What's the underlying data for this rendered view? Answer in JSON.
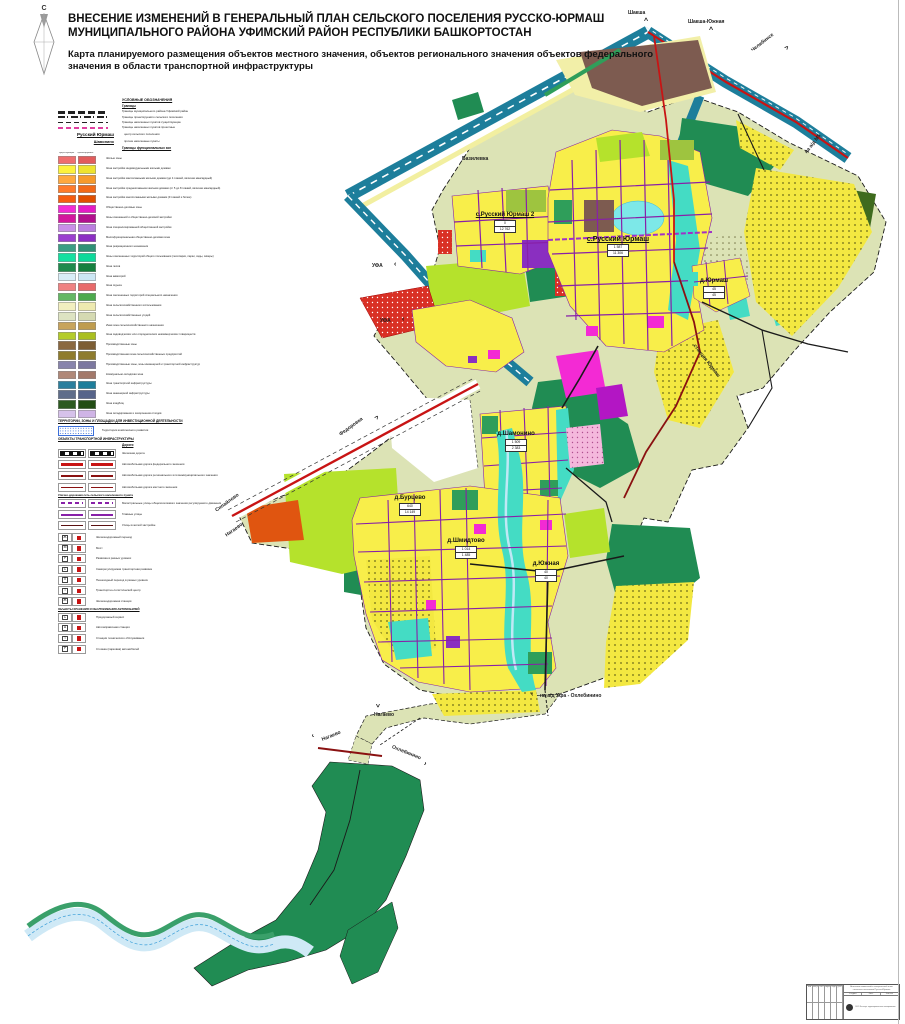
{
  "header": {
    "title": "ВНЕСЕНИЕ ИЗМЕНЕНИЙ В ГЕНЕРАЛЬНЫЙ ПЛАН СЕЛЬСКОГО ПОСЕЛЕНИЯ РУССКО-ЮРМАШ МУНИЦИПАЛЬНОГО РАЙОНА УФИМСКИЙ РАЙОН РЕСПУБЛИКИ БАШКОРТОСТАН",
    "subtitle": "Карта планируемого размещения объектов местного значения, объектов регионального значения объектов федерального значения в области транспортной инфраструктуры",
    "north_label": "С"
  },
  "legend": {
    "title": "УСЛОВНЫЕ ОБОЗНАЧЕНИЯ",
    "boundaries_title": "Границы",
    "boundaries": [
      {
        "style": "b-mun",
        "label": "Границы муниципального района Уфимский район"
      },
      {
        "style": "b-sp",
        "label": "Границы проектируемого сельского поселения"
      },
      {
        "style": "b-npe",
        "label": "Границы населенных пунктов существующие"
      },
      {
        "style": "b-npp",
        "label": "Границы населенных пунктов проектные"
      }
    ],
    "centers": [
      {
        "name": "Русский Юрмаш",
        "desc": "центр сельского поселения",
        "cls": "b"
      },
      {
        "name": "Шамонино",
        "desc": "прочие населенные пункты",
        "cls": "s"
      }
    ],
    "zones_title": "Границы функциональных зон",
    "col_existing": "существующие",
    "col_planned": "проектируемые",
    "zones": [
      {
        "label": "Жилые зоны",
        "c1": "#ef6e6e",
        "c2": "#e25c5c"
      },
      {
        "label": "Зона застройки индивидуальными жилыми домами",
        "c1": "#fdf23c",
        "c2": "#eee32e"
      },
      {
        "label": "Зона застройки малоэтажными жилыми домами (до 4 этажей, включая мансардный)",
        "c1": "#ffa83e",
        "c2": "#f79a2b"
      },
      {
        "label": "Зона застройки среднеэтажными жилыми домами (от 5 до 8 этажей, включая мансардный)",
        "c1": "#ff7a2a",
        "c2": "#f36a18"
      },
      {
        "label": "Зона застройки многоэтажными жилыми домами (9 этажей и более)",
        "c1": "#f65c10",
        "c2": "#e14f00"
      },
      {
        "label": "Общественно-деловые зоны",
        "c1": "#f32ad4",
        "c2": "#e51bc5"
      },
      {
        "label": "Зоны смешанной и общественно-деловой застройки",
        "c1": "#d4179e",
        "c2": "#b30f8e"
      },
      {
        "label": "Зона специализированной общественной застройки",
        "c1": "#c98fe8",
        "c2": "#bb7ee0"
      },
      {
        "label": "Многофункциональная общественно-деловая зона",
        "c1": "#9b3fd0",
        "c2": "#8c2fc4"
      },
      {
        "label": "Зона рекреационного назначения",
        "c1": "#3a9e85",
        "c2": "#2f9177"
      },
      {
        "label": "Зоны озелененных территорий общего пользования (лесопарки, парки, сады, скверы)",
        "c1": "#14e0a0",
        "c2": "#0cd99a"
      },
      {
        "label": "Зона лесов",
        "c1": "#1f8a4d",
        "c2": "#15803f"
      },
      {
        "label": "Зона акваторий",
        "c1": "#d8edf7",
        "c2": "#cce7f4"
      },
      {
        "label": "Зона отдыха",
        "c1": "#ef8282",
        "c2": "#e86a6a"
      },
      {
        "label": "Зона озелененных территорий специального назначения",
        "c1": "#64b864",
        "c2": "#4daa4d"
      },
      {
        "label": "Зона сельскохозяйственного использования",
        "c1": "#f2efc0",
        "c2": "#eeeab0"
      },
      {
        "label": "Зона сельскохозяйственных угодий",
        "c1": "#dde3c2",
        "c2": "#d5dab2"
      },
      {
        "label": "Иная зона сельскохозяйственного назначения",
        "c1": "#c8a45c",
        "c2": "#bf9c4e"
      },
      {
        "label": "Зона садоводческих или огороднических некоммерческих товариществ",
        "c1": "#b4cc2a",
        "c2": "#aabf1f"
      },
      {
        "label": "Производственные зоны",
        "c1": "#8a6840",
        "c2": "#7d5e35"
      },
      {
        "label": "Производственная зона сельскохозяйственных предприятий",
        "c1": "#8f7c2c",
        "c2": "#8e7c2e"
      },
      {
        "label": "Производственные зоны, зоны инженерной и транспортной инфраструктур",
        "c1": "#8884ac",
        "c2": "#7c78a0"
      },
      {
        "label": "Коммунально-складская зона",
        "c1": "#b08878",
        "c2": "#a3796a"
      },
      {
        "label": "Зона транспортной инфраструктуры",
        "c1": "#2b7f9e",
        "c2": "#1d7e9b"
      },
      {
        "label": "Зона инженерной инфраструктуры",
        "c1": "#5f6d8a",
        "c2": "#56648a"
      },
      {
        "label": "Зона кладбищ",
        "c1": "#2c5a20",
        "c2": "#224d14"
      },
      {
        "label": "Зона складирования и захоронения отходов",
        "c1": "#d6c2ea",
        "c2": "#cfb4e6"
      }
    ],
    "invest_title": "ТЕРРИТОРИИ, ЗОНЫ И ПЛОЩАДКИ ДЛЯ ИНВЕСТИЦИОННОЙ ДЕЯТЕЛЬНОСТИ",
    "invest_items": [
      {
        "label": "Территории комплексного развития"
      }
    ],
    "transport_title": "ОБЪЕКТЫ ТРАНСПОРТНОЙ ИНФРАСТРУКТУРЫ",
    "roads_title": "Дороги",
    "roads": [
      {
        "style": "r-rail",
        "label": "Железная дорога"
      },
      {
        "style": "r-fed",
        "label": "Автомобильная дорога федерального значения"
      },
      {
        "style": "r-reg",
        "label": "Автомобильная дорога регионального или межмуниципального значения"
      },
      {
        "style": "r-loc",
        "label": "Автомобильная дорога местного значения"
      }
    ],
    "streets_title": "Улично-дорожная сеть сельского населенного пункта",
    "streets": [
      {
        "style": "r-mag",
        "label": "Магистральные улицы общепоселкового значения регулируемого движения"
      },
      {
        "style": "r-main",
        "label": "Главные улицы"
      },
      {
        "style": "r-liv",
        "label": "Улицы в жилой застройке"
      }
    ],
    "objects": [
      {
        "letter": "Ж",
        "label": "Железнодорожный переезд"
      },
      {
        "letter": "М",
        "label": "Мост"
      },
      {
        "letter": "Р",
        "label": "Развязка в разных уровнях"
      },
      {
        "letter": "С",
        "label": "Саморегулируемая транспортная развязка"
      },
      {
        "letter": "П",
        "label": "Пешеходный переход в разных уровнях"
      },
      {
        "letter": "Т",
        "label": "Транспортно-логистический центр"
      },
      {
        "letter": "Ж",
        "label": "Железнодорожная станция"
      }
    ],
    "objects2_title": "ОБЪЕКТЫ ХРАНЕНИЯ И ОБСЛУЖИВАНИЯ АВТОМОБИЛЕЙ",
    "objects2": [
      {
        "letter": "С",
        "label": "Придорожный сервис"
      },
      {
        "letter": "А",
        "label": "Автозаправочная станция"
      },
      {
        "letter": "Т",
        "label": "Станция технического обслуживания"
      },
      {
        "letter": "Р",
        "label": "Стоянка (парковка) автомобилей"
      }
    ]
  },
  "map": {
    "labels": [
      {
        "text": "Шакша",
        "x": 628,
        "y": 10,
        "rot": 0,
        "cls": "dir"
      },
      {
        "text": "^",
        "x": 644,
        "y": 18,
        "rot": 0,
        "cls": "arr"
      },
      {
        "text": "Шакша-Южная",
        "x": 688,
        "y": 19,
        "rot": 0,
        "cls": "dir"
      },
      {
        "text": "^",
        "x": 709,
        "y": 27,
        "rot": 0,
        "cls": "arr"
      },
      {
        "text": "Челябинск",
        "x": 752,
        "y": 48,
        "rot": -38,
        "cls": "dir"
      },
      {
        "text": "^",
        "x": 784,
        "y": 44,
        "rot": 42,
        "cls": "arr"
      },
      {
        "text": "на а/д М5",
        "x": 806,
        "y": 150,
        "rot": -52,
        "cls": "dir"
      },
      {
        "text": "Базилевка",
        "x": 462,
        "y": 156,
        "rot": 0,
        "cls": "dir"
      },
      {
        "text": "УФА",
        "x": 372,
        "y": 263,
        "rot": 0,
        "cls": "dir"
      },
      {
        "text": "‹",
        "x": 394,
        "y": 261,
        "rot": 0,
        "cls": "arr"
      },
      {
        "text": "УФА",
        "x": 380,
        "y": 318,
        "rot": 0,
        "cls": "dir"
      },
      {
        "text": "‹",
        "x": 402,
        "y": 316,
        "rot": 0,
        "cls": "arr"
      },
      {
        "text": "Федоровка",
        "x": 340,
        "y": 432,
        "rot": -36,
        "cls": "dir"
      },
      {
        "text": "^",
        "x": 374,
        "y": 414,
        "rot": 36,
        "cls": "arr"
      },
      {
        "text": "Сипайлово",
        "x": 216,
        "y": 508,
        "rot": -36,
        "cls": "dir"
      },
      {
        "text": "Нагаево",
        "x": 226,
        "y": 533,
        "rot": -36,
        "cls": "dir"
      },
      {
        "text": "станция Юрмаш",
        "x": 694,
        "y": 342,
        "rot": 52,
        "cls": "dir"
      },
      {
        "text": "на а/д Уфа - Охлебинино",
        "x": 540,
        "y": 693,
        "rot": 0,
        "cls": "dir"
      },
      {
        "text": "‹",
        "x": 531,
        "y": 691,
        "rot": 0,
        "cls": "arr"
      },
      {
        "text": "Нагаево",
        "x": 374,
        "y": 712,
        "rot": 0,
        "cls": "dir"
      },
      {
        "text": "^",
        "x": 380,
        "y": 700,
        "rot": 180,
        "cls": "arr"
      },
      {
        "text": "Нагаево",
        "x": 322,
        "y": 737,
        "rot": -22,
        "cls": "dir"
      },
      {
        "text": "‹",
        "x": 312,
        "y": 733,
        "rot": -22,
        "cls": "arr"
      },
      {
        "text": "Охлебинино",
        "x": 392,
        "y": 744,
        "rot": 22,
        "cls": "dir"
      },
      {
        "text": "›",
        "x": 424,
        "y": 760,
        "rot": 22,
        "cls": "arr"
      }
    ],
    "settlements": [
      {
        "name": "с.Русский Юрмаш 2",
        "x": 505,
        "y": 212,
        "cls": "city md",
        "pop_existing": "0",
        "pop_planned": "12 762"
      },
      {
        "name": "с.Русский Юрмаш",
        "x": 618,
        "y": 236,
        "cls": "city lg",
        "pop_existing": "1 587",
        "pop_planned": "11 306"
      },
      {
        "name": "д.Юрмаш",
        "x": 714,
        "y": 278,
        "cls": "city",
        "pop_existing": "45",
        "pop_planned": "45"
      },
      {
        "name": "д.Шамонино",
        "x": 516,
        "y": 431,
        "cls": "city",
        "pop_existing": "1 509",
        "pop_planned": "2 383"
      },
      {
        "name": "д.Бурцево",
        "x": 410,
        "y": 495,
        "cls": "city",
        "pop_existing": "640",
        "pop_planned": "14 149"
      },
      {
        "name": "д.Шмидтово",
        "x": 466,
        "y": 538,
        "cls": "city",
        "pop_existing": "1 014",
        "pop_planned": "1 485"
      },
      {
        "name": "д.Южная",
        "x": 546,
        "y": 561,
        "cls": "city",
        "pop_existing": "40",
        "pop_planned": "40"
      }
    ]
  },
  "stamp": {
    "doc_line1": "Внесение изменений в генеральный план",
    "doc_line2": "сельского поселения Русско-Юрмаш",
    "cells": [
      "Изм",
      "Кол.уч",
      "Лист",
      "№док",
      "Подп",
      "Дата"
    ],
    "stage_label": "Стадия",
    "sheet_label": "Лист",
    "sheets_label": "Листов",
    "stage": "П",
    "org_line": "ООО Институт территориального планирования"
  }
}
